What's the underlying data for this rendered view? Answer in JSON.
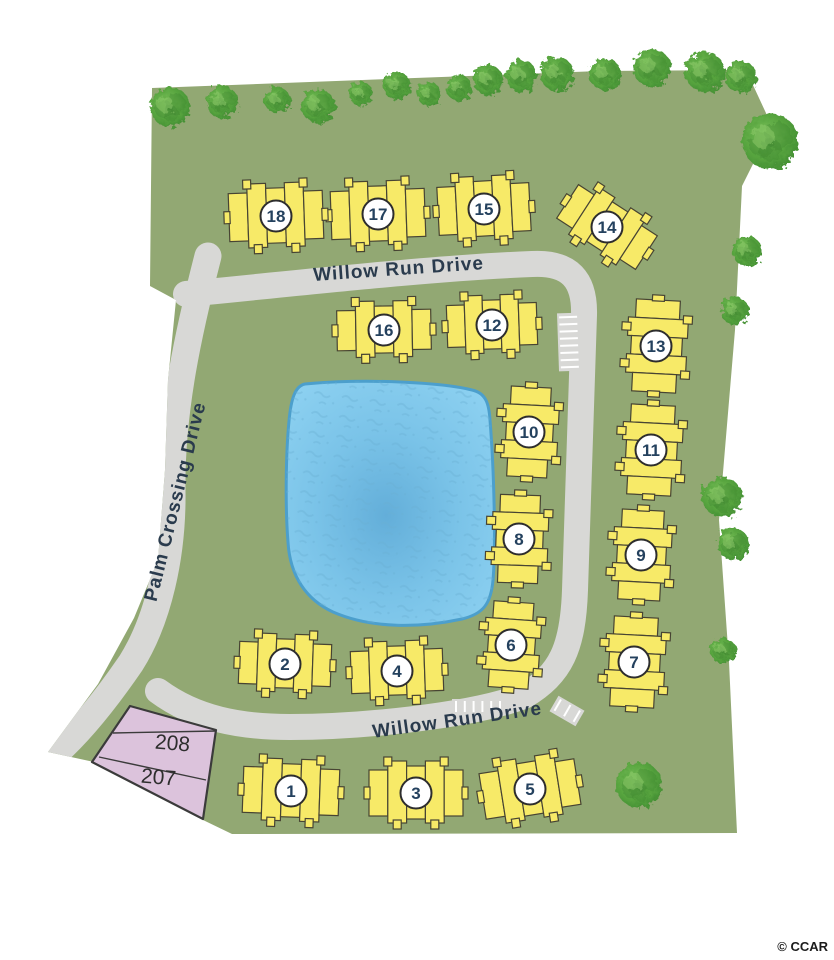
{
  "map": {
    "credit": "© CCAR",
    "colors": {
      "background": "#ffffff",
      "land": "#92A873",
      "road": "#D8D8D6",
      "building_fill": "#F7EA68",
      "building_stroke": "#474433",
      "circle_fill": "#FFFFFF",
      "circle_stroke": "#2D2D2D",
      "number_text": "#24415E",
      "street_text": "#2A3B4D",
      "pond_fill_center": "#63AED9",
      "pond_fill_mid": "#7AC3E8",
      "pond_fill_edge": "#8DD1F1",
      "pond_edge": "#4C9FCC",
      "pond_texture": "#69AFD3",
      "lot_fill": "#DCC3DC",
      "lot_stroke": "#3B3B3B",
      "lot_text": "#2E2E2E",
      "tree_dark": "#397F2C",
      "tree_mid": "#58A53F",
      "tree_light": "#8FCB6B",
      "parking_tick": "#FFFFFF"
    },
    "land_path": "M152,88 L600,71 L746,70 L772,126 L742,186 L735,330 L719,520 L729,662 L737,833 L232,834 L203,820 L94,762 L48,752 L98,684 L134,618 L158,560 L165,470 L168,380 L176,300 L150,286 Z",
    "roads": [
      {
        "name": "palm-crossing-drive",
        "width": 27,
        "path": "M208,256 C189,330 171,410 172,490 C173,556 158,620 131,663 C107,698 81,731 55,754"
      },
      {
        "name": "willow-run-loop",
        "width": 26,
        "path": "M186,294 C290,284 430,268 532,264 C570,262 585,280 584,315 L575,590 C573,648 561,674 524,696 C468,717 356,727 290,727 C240,727 196,719 158,691"
      }
    ],
    "parking": [
      {
        "name": "parking-east",
        "x": 558,
        "y": 313,
        "w": 24,
        "h": 58,
        "rot": -2,
        "ticks": 8,
        "dir": "h"
      },
      {
        "name": "parking-south",
        "x": 452,
        "y": 699,
        "w": 52,
        "h": 16,
        "rot": 0,
        "ticks": 6,
        "dir": "v"
      },
      {
        "name": "parking-bend",
        "x": 552,
        "y": 702,
        "w": 30,
        "h": 18,
        "rot": 30,
        "ticks": 3,
        "dir": "v"
      }
    ],
    "pond": {
      "name": "pond",
      "path": "M305,384 C370,378 445,383 472,390 C486,393 489,404 490,420 C494,470 496,545 493,580 C491,604 483,614 462,619 C420,628 372,629 333,612 C307,600 290,577 288,542 C285,505 286,452 289,421 C291,399 295,386 305,384 Z"
    },
    "lots": {
      "outline": "130,706 216,730 203,819 92,762",
      "lines": [
        {
          "x1": 113,
          "y1": 733,
          "x2": 216,
          "y2": 731
        },
        {
          "x1": 99,
          "y1": 757,
          "x2": 206,
          "y2": 780
        }
      ],
      "numbers": [
        {
          "label": "208",
          "x": 172,
          "y": 750,
          "rotate": 5
        },
        {
          "label": "207",
          "x": 158,
          "y": 784,
          "rotate": 5
        }
      ]
    },
    "streets": [
      {
        "label": "Willow Run Drive",
        "x": 399,
        "y": 275,
        "rotate": -4,
        "size": 19
      },
      {
        "label": "Willow Run Drive",
        "x": 458,
        "y": 726,
        "rotate": -8,
        "size": 19
      },
      {
        "label": "Palm Crossing Drive",
        "x": 181,
        "y": 503,
        "rotate": -76,
        "size": 19
      }
    ],
    "buildings": [
      {
        "label": "1",
        "cx": 291,
        "cy": 791,
        "w": 96,
        "h": 64,
        "rot": 2,
        "units": 5
      },
      {
        "label": "2",
        "cx": 285,
        "cy": 664,
        "w": 92,
        "h": 60,
        "rot": 2,
        "units": 5
      },
      {
        "label": "3",
        "cx": 416,
        "cy": 793,
        "w": 94,
        "h": 64,
        "rot": 0,
        "units": 5
      },
      {
        "label": "4",
        "cx": 397,
        "cy": 671,
        "w": 92,
        "h": 60,
        "rot": -2,
        "units": 5
      },
      {
        "label": "5",
        "cx": 530,
        "cy": 789,
        "w": 96,
        "h": 64,
        "rot": -9,
        "units": 5
      },
      {
        "label": "6",
        "cx": 511,
        "cy": 645,
        "w": 86,
        "h": 58,
        "rot": 94,
        "units": 5
      },
      {
        "label": "7",
        "cx": 634,
        "cy": 662,
        "w": 90,
        "h": 62,
        "rot": 93,
        "units": 5
      },
      {
        "label": "8",
        "cx": 519,
        "cy": 539,
        "w": 88,
        "h": 58,
        "rot": 92,
        "units": 5
      },
      {
        "label": "9",
        "cx": 641,
        "cy": 555,
        "w": 90,
        "h": 60,
        "rot": 93,
        "units": 5
      },
      {
        "label": "10",
        "cx": 529,
        "cy": 432,
        "w": 90,
        "h": 58,
        "rot": 93,
        "units": 5
      },
      {
        "label": "11",
        "cx": 651,
        "cy": 450,
        "w": 90,
        "h": 62,
        "rot": 93,
        "units": 5
      },
      {
        "label": "12",
        "cx": 492,
        "cy": 325,
        "w": 90,
        "h": 60,
        "rot": -2,
        "units": 5
      },
      {
        "label": "13",
        "cx": 656,
        "cy": 346,
        "w": 92,
        "h": 62,
        "rot": 93,
        "units": 5
      },
      {
        "label": "14",
        "cx": 607,
        "cy": 227,
        "w": 94,
        "h": 58,
        "rot": 33,
        "units": 5
      },
      {
        "label": "15",
        "cx": 484,
        "cy": 209,
        "w": 92,
        "h": 66,
        "rot": -3,
        "units": 5
      },
      {
        "label": "16",
        "cx": 384,
        "cy": 330,
        "w": 94,
        "h": 58,
        "rot": -1,
        "units": 5
      },
      {
        "label": "17",
        "cx": 378,
        "cy": 214,
        "w": 94,
        "h": 66,
        "rot": -2,
        "units": 5
      },
      {
        "label": "18",
        "cx": 276,
        "cy": 216,
        "w": 94,
        "h": 66,
        "rot": -2,
        "units": 5
      }
    ],
    "trees": [
      {
        "x": 170,
        "y": 107,
        "r": 20
      },
      {
        "x": 222,
        "y": 102,
        "r": 16
      },
      {
        "x": 277,
        "y": 100,
        "r": 13
      },
      {
        "x": 318,
        "y": 106,
        "r": 17
      },
      {
        "x": 361,
        "y": 94,
        "r": 12
      },
      {
        "x": 397,
        "y": 86,
        "r": 14
      },
      {
        "x": 429,
        "y": 94,
        "r": 12
      },
      {
        "x": 459,
        "y": 88,
        "r": 13
      },
      {
        "x": 488,
        "y": 80,
        "r": 15
      },
      {
        "x": 521,
        "y": 76,
        "r": 16
      },
      {
        "x": 557,
        "y": 74,
        "r": 17
      },
      {
        "x": 605,
        "y": 74,
        "r": 16
      },
      {
        "x": 652,
        "y": 68,
        "r": 19
      },
      {
        "x": 705,
        "y": 72,
        "r": 20
      },
      {
        "x": 741,
        "y": 77,
        "r": 16
      },
      {
        "x": 770,
        "y": 141,
        "r": 28
      },
      {
        "x": 747,
        "y": 251,
        "r": 15
      },
      {
        "x": 735,
        "y": 311,
        "r": 14
      },
      {
        "x": 722,
        "y": 497,
        "r": 20
      },
      {
        "x": 733,
        "y": 544,
        "r": 16
      },
      {
        "x": 723,
        "y": 651,
        "r": 13
      },
      {
        "x": 639,
        "y": 785,
        "r": 23
      }
    ]
  }
}
